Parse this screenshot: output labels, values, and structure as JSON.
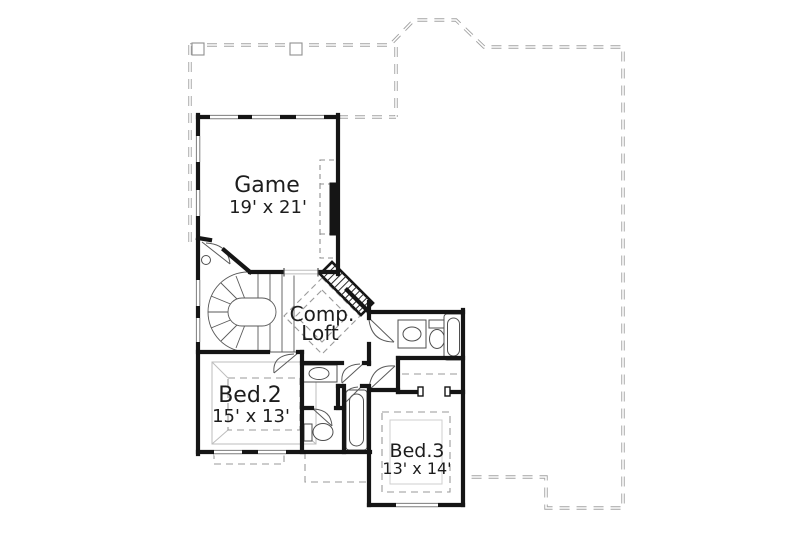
{
  "canvas": {
    "width": 800,
    "height": 535,
    "background": "#ffffff"
  },
  "palette": {
    "wall": "#151515",
    "thin_line": "#4f4f4f",
    "light_line": "#b5b5b5",
    "dashed_line": "#8f8f8f",
    "roof_dash": "#a3a3a3",
    "text": "#1d1d1d"
  },
  "plan": {
    "floor_label_style": "architectural second-floor plan",
    "rooms": {
      "game": {
        "name": "Game",
        "dimensions": "19' x 21'"
      },
      "comp_loft": {
        "name_line1": "Comp.",
        "name_line2": "Loft"
      },
      "bed2": {
        "name": "Bed.2",
        "dimensions": "15' x 13'"
      },
      "bed3": {
        "name": "Bed.3",
        "dimensions": "13' x 14'"
      }
    }
  }
}
